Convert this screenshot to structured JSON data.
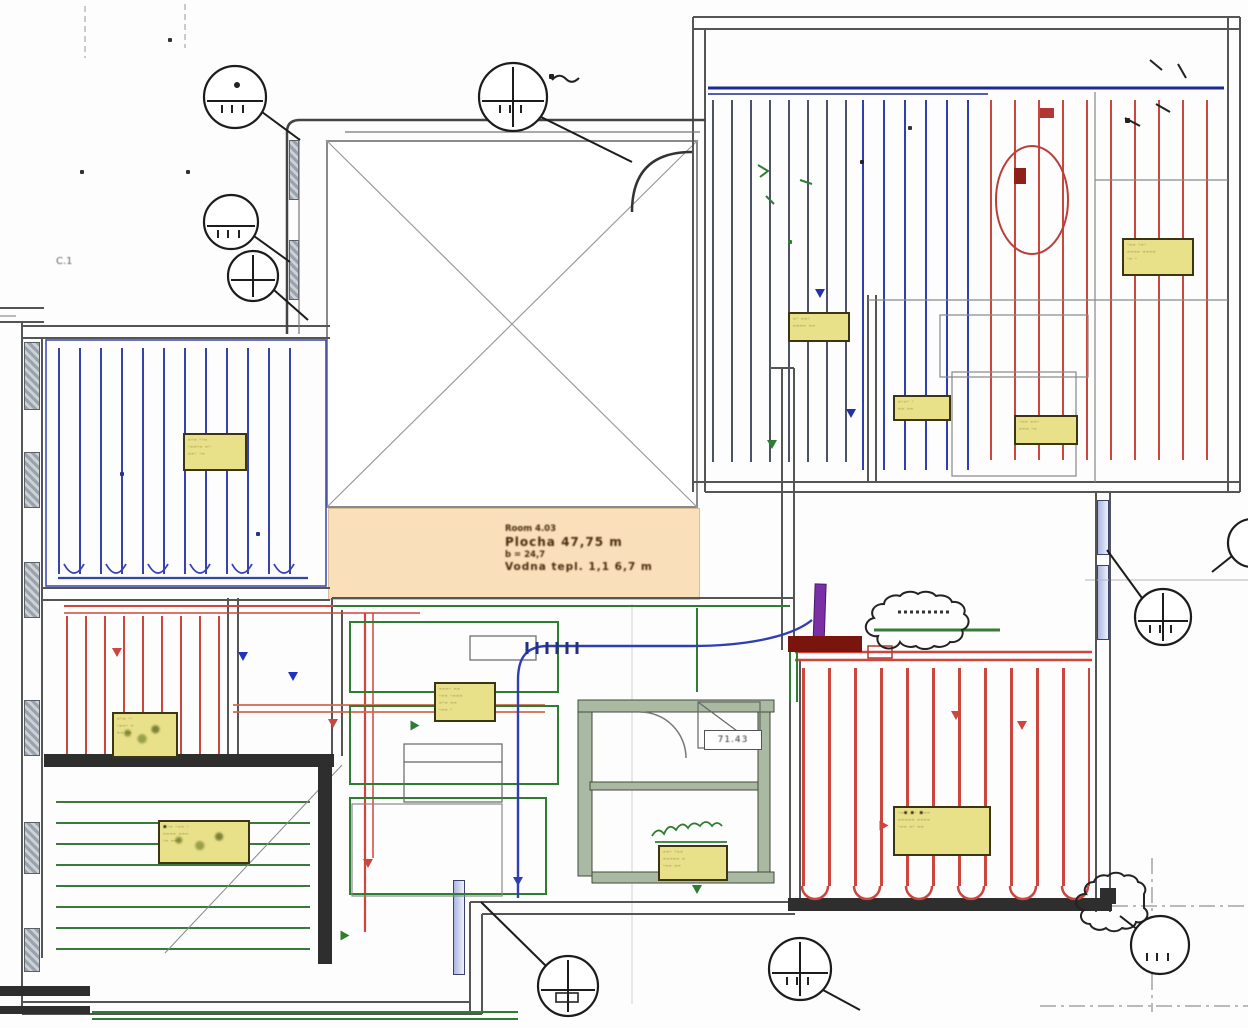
{
  "document": {
    "type": "underfloor-heating-floor-plan",
    "left_note": "C.1",
    "bath_value": "71.43",
    "spec_note": {
      "lines": [
        "Room 4.03",
        "Plocha 47,75 m",
        "b = 24,7",
        "Vodna tepl. 1,1  6,7 m"
      ]
    }
  },
  "colors": {
    "pipe_blue": "#2f3fae",
    "pipe_navy_header": "#1b2a94",
    "pipe_red": "#cc463e",
    "pipe_orange_red": "#d0694f",
    "pipe_green": "#2f7d33",
    "pipe_gray": "#4d5268",
    "manifold_purple": "#7b2fa5",
    "manifold_dark_red": "#7a150e",
    "label_yellow": "#e9e18a",
    "tan_note": "#f9e0bb",
    "wall_gray": "#555555",
    "wall_dark": "#2e2e2e"
  },
  "pipefields": [
    {
      "name": "pipes-top-left-room-blue",
      "x": 58,
      "y": 348,
      "w": 252,
      "h": 226,
      "dir": "v",
      "sp": 21,
      "t": 2,
      "color": "#3642ad"
    },
    {
      "name": "pipes-top-right-room-gray",
      "x": 712,
      "y": 100,
      "w": 150,
      "h": 362,
      "dir": "v",
      "sp": 19,
      "t": 2,
      "color": "#4d5268"
    },
    {
      "name": "pipes-top-right-room-blue",
      "x": 862,
      "y": 100,
      "w": 126,
      "h": 370,
      "dir": "v",
      "sp": 21,
      "t": 2,
      "color": "#2f3fae"
    },
    {
      "name": "pipes-top-right-room-red",
      "x": 990,
      "y": 100,
      "w": 236,
      "h": 360,
      "dir": "v",
      "sp": 24,
      "t": 2,
      "color": "#cc463e"
    },
    {
      "name": "pipes-left-mid-room-red",
      "x": 66,
      "y": 616,
      "w": 158,
      "h": 138,
      "dir": "v",
      "sp": 19,
      "t": 2,
      "color": "#cc463e"
    },
    {
      "name": "pipes-bottom-left-room-green",
      "x": 56,
      "y": 790,
      "w": 254,
      "h": 160,
      "dir": "h",
      "sp": 21,
      "t": 2,
      "color": "#3a783b"
    },
    {
      "name": "pipes-bottom-right-room-red",
      "x": 802,
      "y": 668,
      "w": 288,
      "h": 218,
      "dir": "v",
      "sp": 26,
      "t": 3,
      "color": "#cc463e"
    }
  ],
  "labels": [
    {
      "name": "loop-label-tl-room",
      "x": 183,
      "y": 433,
      "w": 64,
      "h": 38,
      "blot": false,
      "lines": [
        "–·– ··–",
        "·––·– –·",
        "––· ·–"
      ]
    },
    {
      "name": "loop-label-tr-1",
      "x": 1122,
      "y": 238,
      "w": 72,
      "h": 38,
      "blot": false,
      "lines": [
        "·–– ·–·",
        "––––  ––––",
        "·– ·"
      ]
    },
    {
      "name": "loop-label-tr-2",
      "x": 788,
      "y": 312,
      "w": 62,
      "h": 30,
      "blot": false,
      "lines": [
        "–· ––·",
        "–––– ––"
      ]
    },
    {
      "name": "loop-label-tr-3",
      "x": 893,
      "y": 395,
      "w": 58,
      "h": 26,
      "blot": false,
      "lines": [
        "–·–· ·",
        "–– ––"
      ]
    },
    {
      "name": "loop-label-tr-4",
      "x": 1014,
      "y": 415,
      "w": 64,
      "h": 30,
      "blot": false,
      "lines": [
        "·–– ––·",
        "––– ·–"
      ]
    },
    {
      "name": "loop-label-hall",
      "x": 434,
      "y": 682,
      "w": 62,
      "h": 40,
      "blot": false,
      "lines": [
        "–––· ––",
        "·–– ·–––",
        "–·– ––",
        "·–– ·"
      ]
    },
    {
      "name": "loop-label-bath",
      "x": 658,
      "y": 845,
      "w": 70,
      "h": 36,
      "blot": false,
      "lines": [
        "––· ·––",
        "––––– –",
        "·–– ––"
      ]
    },
    {
      "name": "loop-label-br-room",
      "x": 893,
      "y": 806,
      "w": 98,
      "h": 50,
      "blot": false,
      "lines": [
        "·–▪ ▪· ▪––",
        "––––– ––––",
        "·–– –· ––"
      ]
    },
    {
      "name": "loop-label-bl-room",
      "x": 158,
      "y": 820,
      "w": 92,
      "h": 44,
      "blot": true,
      "lines": [
        "▪·– ·–– ·",
        "–––– –––",
        "·– ––·"
      ]
    },
    {
      "name": "loop-label-lm-room",
      "x": 112,
      "y": 712,
      "w": 66,
      "h": 46,
      "blot": true,
      "lines": [
        "–·– ··",
        "·––· –",
        "–– ·–"
      ]
    }
  ],
  "callouts": [
    {
      "name": "callout-top-left-1",
      "cx": 235,
      "cy": 97,
      "r": 31,
      "style": "chord",
      "ticks": true,
      "dot": true,
      "box": false,
      "leader": [
        [
          262,
          112
        ],
        [
          300,
          140
        ]
      ]
    },
    {
      "name": "callout-top-left-2",
      "cx": 231,
      "cy": 222,
      "r": 27,
      "style": "chord",
      "ticks": true,
      "dot": false,
      "box": false,
      "leader": [
        [
          254,
          236
        ],
        [
          290,
          262
        ]
      ]
    },
    {
      "name": "callout-top-left-3",
      "cx": 253,
      "cy": 276,
      "r": 25,
      "style": "cross",
      "ticks": false,
      "dot": false,
      "box": false,
      "leader": [
        [
          274,
          290
        ],
        [
          308,
          320
        ]
      ]
    },
    {
      "name": "callout-top-center",
      "cx": 513,
      "cy": 97,
      "r": 34,
      "style": "cross",
      "ticks": true,
      "dot": false,
      "box": false,
      "leader": [
        [
          541,
          117
        ],
        [
          632,
          162
        ]
      ]
    },
    {
      "name": "callout-right-mid",
      "cx": 1163,
      "cy": 617,
      "r": 28,
      "style": "cross",
      "ticks": true,
      "dot": false,
      "box": false,
      "leader": [
        [
          1142,
          598
        ],
        [
          1107,
          550
        ]
      ]
    },
    {
      "name": "callout-right-edge-partial",
      "cx": 1252,
      "cy": 543,
      "r": 24,
      "style": "plain",
      "ticks": false,
      "dot": false,
      "box": false,
      "leader": [
        [
          1232,
          556
        ],
        [
          1212,
          572
        ]
      ]
    },
    {
      "name": "callout-bottom-center",
      "cx": 568,
      "cy": 986,
      "r": 30,
      "style": "cross",
      "ticks": false,
      "dot": false,
      "box": true,
      "leader": [
        [
          546,
          966
        ],
        [
          481,
          902
        ]
      ]
    },
    {
      "name": "callout-bottom-mid",
      "cx": 800,
      "cy": 969,
      "r": 31,
      "style": "cross",
      "ticks": true,
      "dot": false,
      "box": false,
      "leader": [
        [
          823,
          990
        ],
        [
          860,
          1010
        ]
      ]
    },
    {
      "name": "callout-bottom-right",
      "cx": 1160,
      "cy": 945,
      "r": 29,
      "style": "plain",
      "ticks": true,
      "dot": false,
      "box": false,
      "leader": [
        [
          1138,
          930
        ],
        [
          1120,
          916
        ]
      ]
    }
  ],
  "arrows": [
    {
      "x": 518,
      "y": 882,
      "d": "down",
      "c": "#2f3fb3"
    },
    {
      "x": 820,
      "y": 294,
      "d": "down",
      "c": "#2233aa"
    },
    {
      "x": 243,
      "y": 657,
      "d": "down",
      "c": "#2233bb"
    },
    {
      "x": 293,
      "y": 677,
      "d": "down",
      "c": "#2233bb"
    },
    {
      "x": 851,
      "y": 414,
      "d": "down",
      "c": "#2233aa"
    },
    {
      "x": 368,
      "y": 864,
      "d": "down",
      "c": "#cc463e"
    },
    {
      "x": 884,
      "y": 826,
      "d": "right",
      "c": "#cc463e"
    },
    {
      "x": 1022,
      "y": 726,
      "d": "down",
      "c": "#cc463e"
    },
    {
      "x": 333,
      "y": 724,
      "d": "down",
      "c": "#cc463e"
    },
    {
      "x": 117,
      "y": 653,
      "d": "down",
      "c": "#cc463e"
    },
    {
      "x": 956,
      "y": 716,
      "d": "down",
      "c": "#cc463e"
    },
    {
      "x": 415,
      "y": 726,
      "d": "right",
      "c": "#2f7d33"
    },
    {
      "x": 697,
      "y": 890,
      "d": "down",
      "c": "#2f7d33"
    },
    {
      "x": 345,
      "y": 936,
      "d": "right",
      "c": "#2f7d33"
    },
    {
      "x": 772,
      "y": 445,
      "d": "down",
      "c": "#2f7d33"
    }
  ],
  "windows": [
    {
      "x": 24,
      "y": 342,
      "w": 16,
      "h": 68,
      "kind": "hatch"
    },
    {
      "x": 24,
      "y": 452,
      "w": 16,
      "h": 56,
      "kind": "hatch"
    },
    {
      "x": 24,
      "y": 562,
      "w": 16,
      "h": 56,
      "kind": "hatch"
    },
    {
      "x": 24,
      "y": 700,
      "w": 16,
      "h": 56,
      "kind": "hatch"
    },
    {
      "x": 24,
      "y": 822,
      "w": 16,
      "h": 52,
      "kind": "hatch"
    },
    {
      "x": 24,
      "y": 928,
      "w": 16,
      "h": 44,
      "kind": "hatch"
    },
    {
      "x": 289,
      "y": 140,
      "w": 10,
      "h": 60,
      "kind": "hatch"
    },
    {
      "x": 289,
      "y": 240,
      "w": 10,
      "h": 60,
      "kind": "hatch"
    },
    {
      "x": 1097,
      "y": 500,
      "w": 12,
      "h": 55,
      "kind": "glass"
    },
    {
      "x": 1097,
      "y": 565,
      "w": 12,
      "h": 75,
      "kind": "glass"
    },
    {
      "x": 453,
      "y": 880,
      "w": 12,
      "h": 95,
      "kind": "glass"
    }
  ],
  "marks": [
    {
      "x": 168,
      "y": 38,
      "s": 4,
      "c": "#333333"
    },
    {
      "x": 80,
      "y": 170,
      "s": 4,
      "c": "#333333"
    },
    {
      "x": 186,
      "y": 170,
      "s": 4,
      "c": "#333333"
    },
    {
      "x": 120,
      "y": 472,
      "s": 4,
      "c": "#27338f"
    },
    {
      "x": 256,
      "y": 532,
      "s": 4,
      "c": "#27338f"
    },
    {
      "x": 1125,
      "y": 118,
      "s": 5,
      "c": "#222222"
    },
    {
      "x": 549,
      "y": 74,
      "s": 5,
      "c": "#222222"
    },
    {
      "x": 908,
      "y": 126,
      "s": 4,
      "c": "#333344"
    },
    {
      "x": 860,
      "y": 160,
      "s": 4,
      "c": "#222233"
    },
    {
      "x": 788,
      "y": 240,
      "s": 4,
      "c": "#2f7d33"
    }
  ]
}
